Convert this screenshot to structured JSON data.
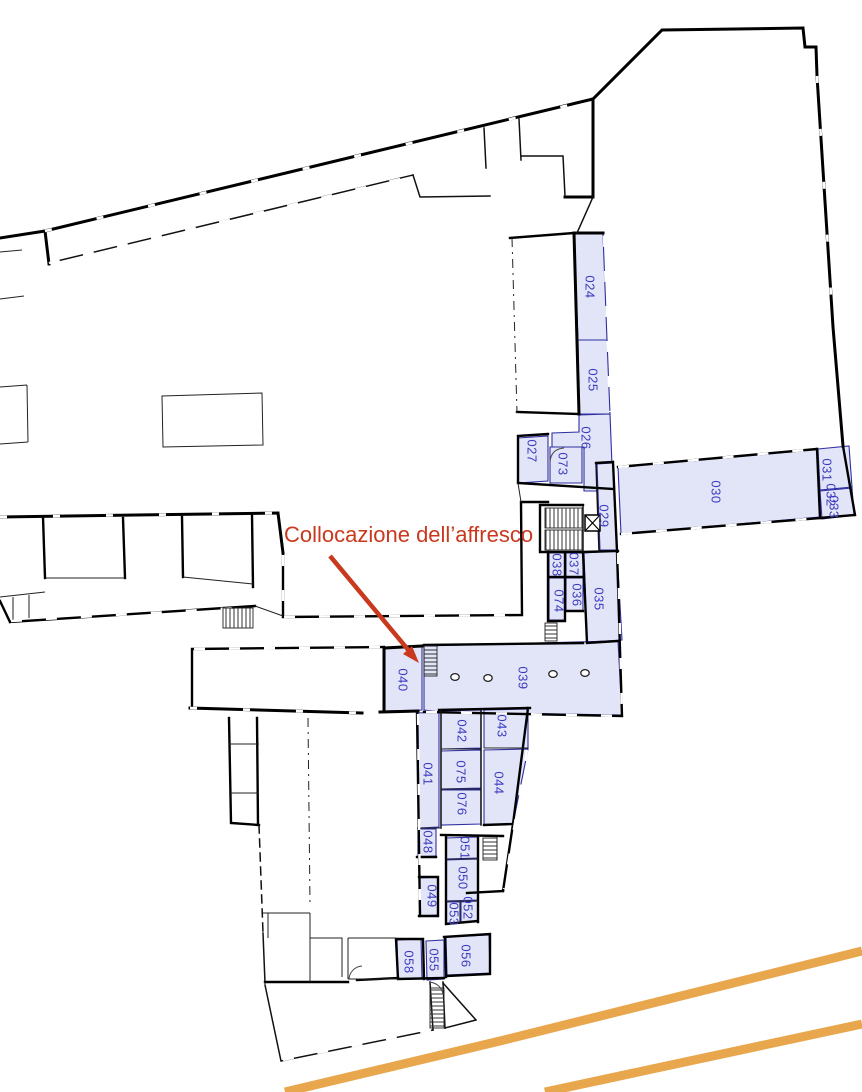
{
  "annotation": {
    "text": "Collocazione dell’affresco"
  },
  "highlighted_rooms": [
    "024",
    "025",
    "026",
    "027",
    "073",
    "029",
    "030",
    "031",
    "032",
    "033",
    "035",
    "036",
    "037",
    "038",
    "074",
    "039",
    "040",
    "041",
    "042",
    "043",
    "044",
    "075",
    "076",
    "048",
    "049",
    "051",
    "050",
    "052",
    "053",
    "058",
    "055",
    "056"
  ],
  "colors": {
    "room_fill": "#e2e4f8",
    "room_border": "#2f2fa0",
    "room_label": "#3b3bc0",
    "wall": "#000000",
    "annotation": "#c9391e",
    "road": "#e9a74d"
  }
}
